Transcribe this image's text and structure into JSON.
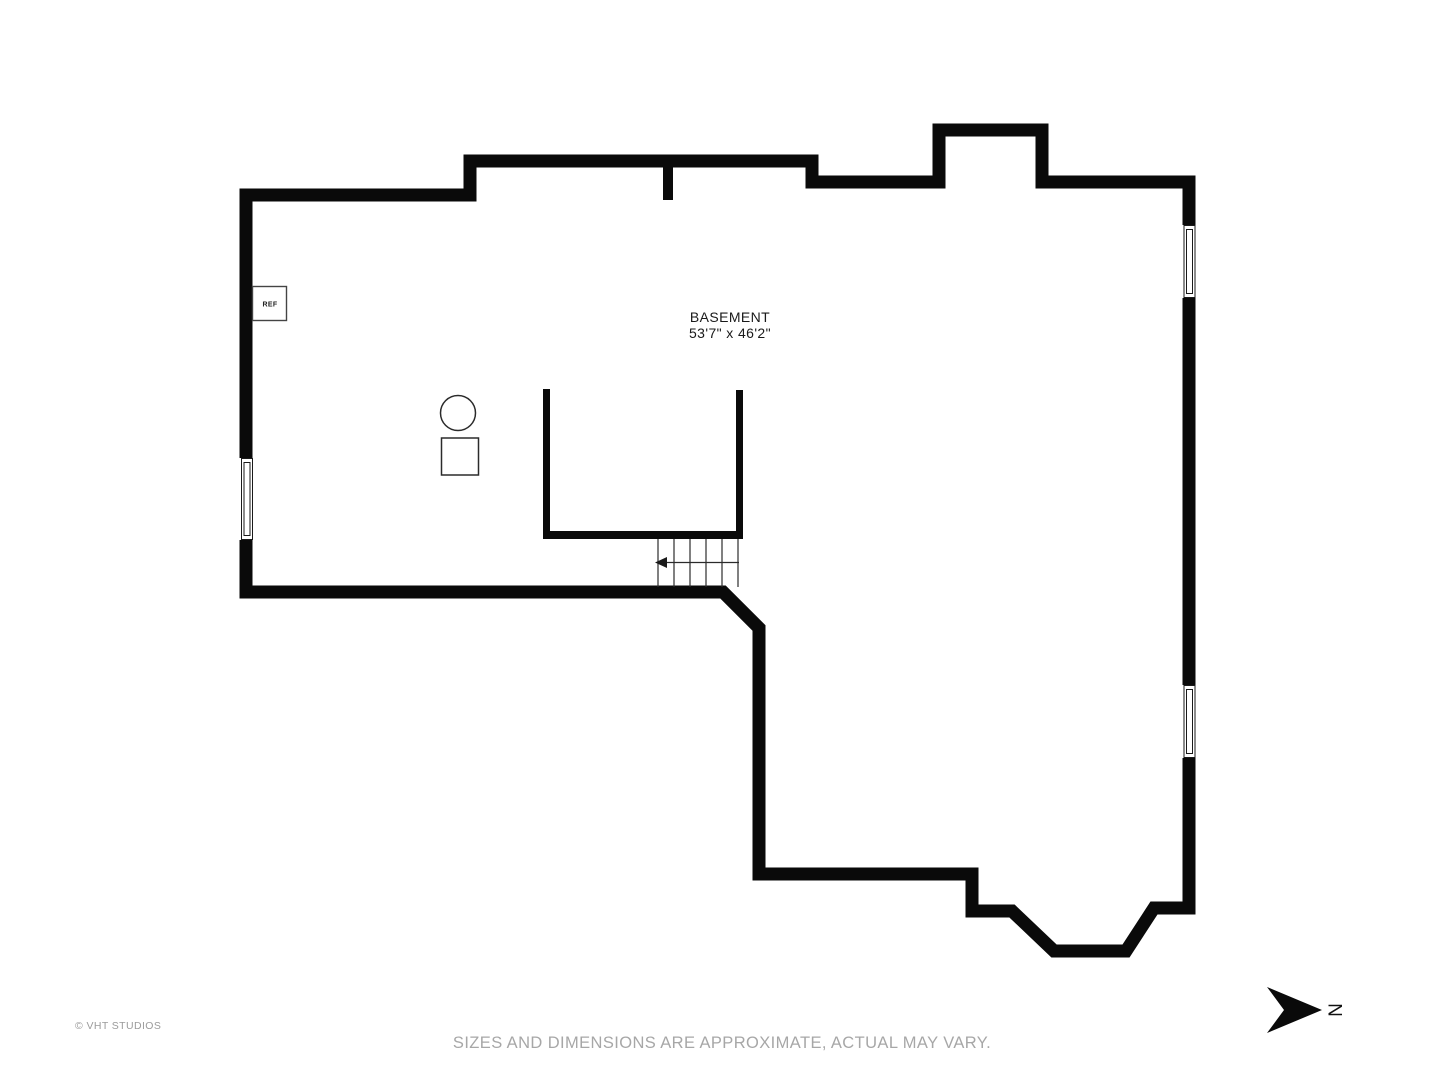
{
  "plan": {
    "room": {
      "label": "BASEMENT",
      "dimensions": "53'7\" x 46'2\""
    },
    "appliances": {
      "refrigerator_label": "REF"
    },
    "compass": {
      "north_letter": "N"
    }
  },
  "footer": {
    "copyright": "© VHT STUDIOS",
    "disclaimer": "SIZES AND DIMENSIONS ARE APPROXIMATE, ACTUAL MAY VARY."
  },
  "colors": {
    "wall": "#0a0a0a",
    "background": "#ffffff",
    "muted_text": "#a7a7a7",
    "label_text": "#1a1a1a"
  }
}
